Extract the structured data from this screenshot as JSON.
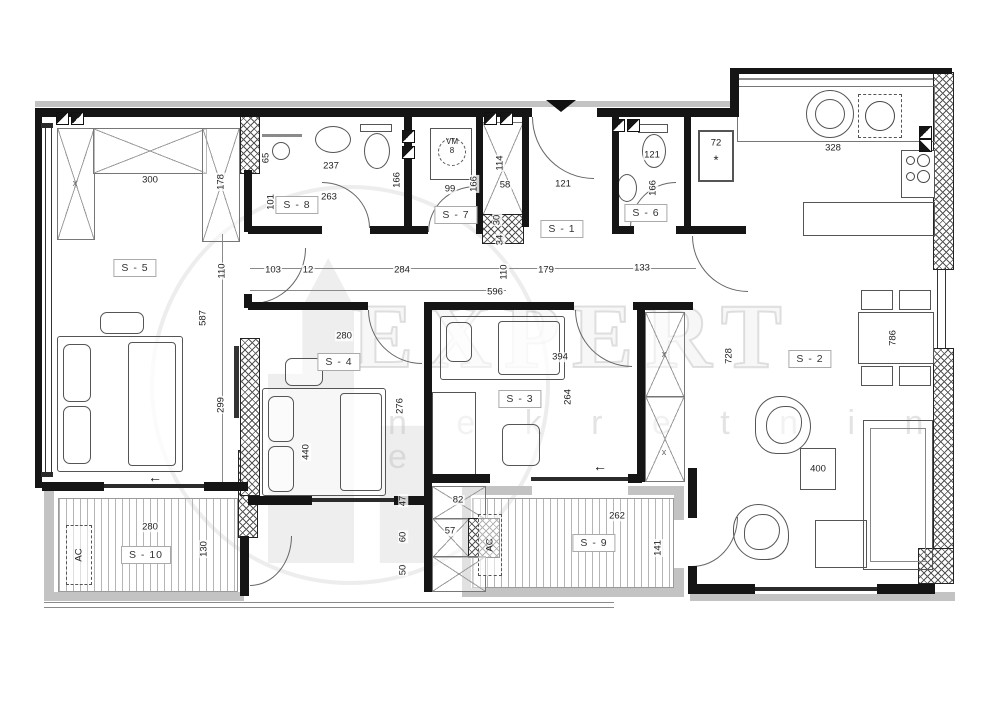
{
  "watermark": {
    "brand": "EXPERT",
    "tagline": "n e k r e t n i n e"
  },
  "rooms": {
    "s1": "S - 1",
    "s2": "S - 2",
    "s3": "S - 3",
    "s4": "S - 4",
    "s5": "S - 5",
    "s6": "S - 6",
    "s7": "S - 7",
    "s8": "S - 8",
    "s9": "S - 9",
    "s10": "S - 10"
  },
  "fixtures": {
    "washing_machine_top": "VM",
    "washing_machine_bottom": "8",
    "ac_unit": "AC",
    "shaft_value": "72",
    "shaft_mark": "*",
    "wardrobe_mark": "x"
  },
  "colors": {
    "wall": "#151515",
    "gray_band": "#c3c3c3",
    "dim_text": "#1d1d1d",
    "watermark": "#c3c3c3"
  },
  "dims": {
    "d12": "12",
    "d30": "30",
    "d34": "34",
    "d47": "47",
    "d50": "50",
    "d57": "57",
    "d58": "58",
    "d60": "60",
    "d65": "65",
    "d82": "82",
    "d99": "99",
    "d101": "101",
    "d103": "103",
    "d110": "110",
    "d114": "114",
    "d121": "121",
    "d130": "130",
    "d133": "133",
    "d141": "141",
    "d166": "166",
    "d178": "178",
    "d179": "179",
    "d237": "237",
    "d262": "262",
    "d263": "263",
    "d264": "264",
    "d276": "276",
    "d280": "280",
    "d284": "284",
    "d299": "299",
    "d300": "300",
    "d328": "328",
    "d394": "394",
    "d400": "400",
    "d440": "440",
    "d587": "587",
    "d596": "596",
    "d728": "728",
    "d786": "786"
  }
}
